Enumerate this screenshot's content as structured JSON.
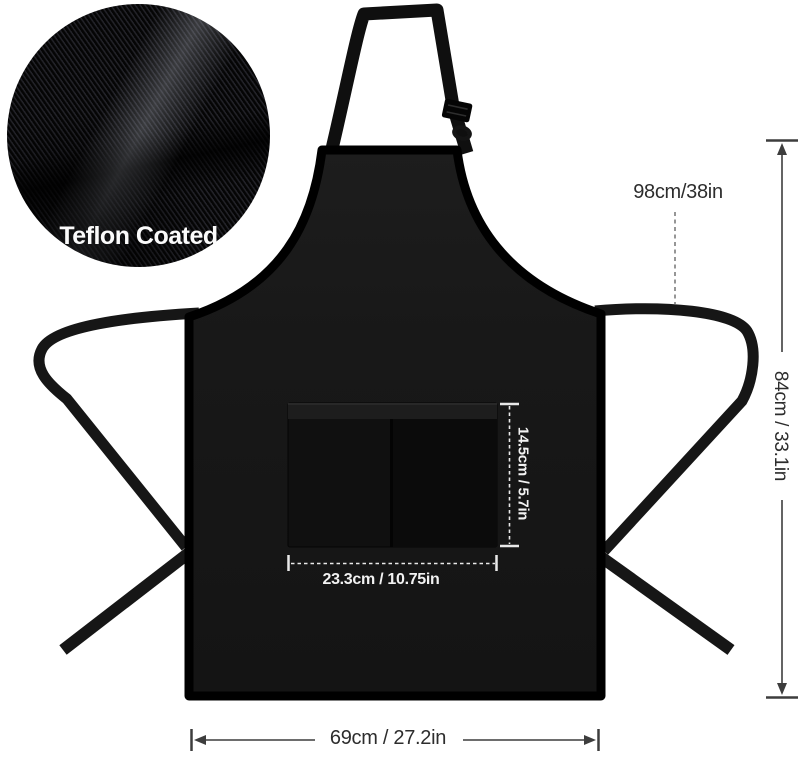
{
  "figure": {
    "type": "product dimension diagram",
    "subject": "black bib apron with adjustable neck strap, waist ties and two-compartment front pocket"
  },
  "fabric_detail": {
    "label": "Teflon Coated"
  },
  "dimensions": {
    "tie_strap_length": "98cm/38in",
    "apron_height": "84cm / 33.1in",
    "pocket_height": "14.5cm / 5.7in",
    "pocket_width": "23.3cm / 10.75in",
    "apron_width": "69cm / 27.2in"
  },
  "colors": {
    "background": "#ffffff",
    "apron_fabric": "#181818",
    "annotation_dark": "#2f2f2f",
    "annotation_light": "#ededed"
  }
}
